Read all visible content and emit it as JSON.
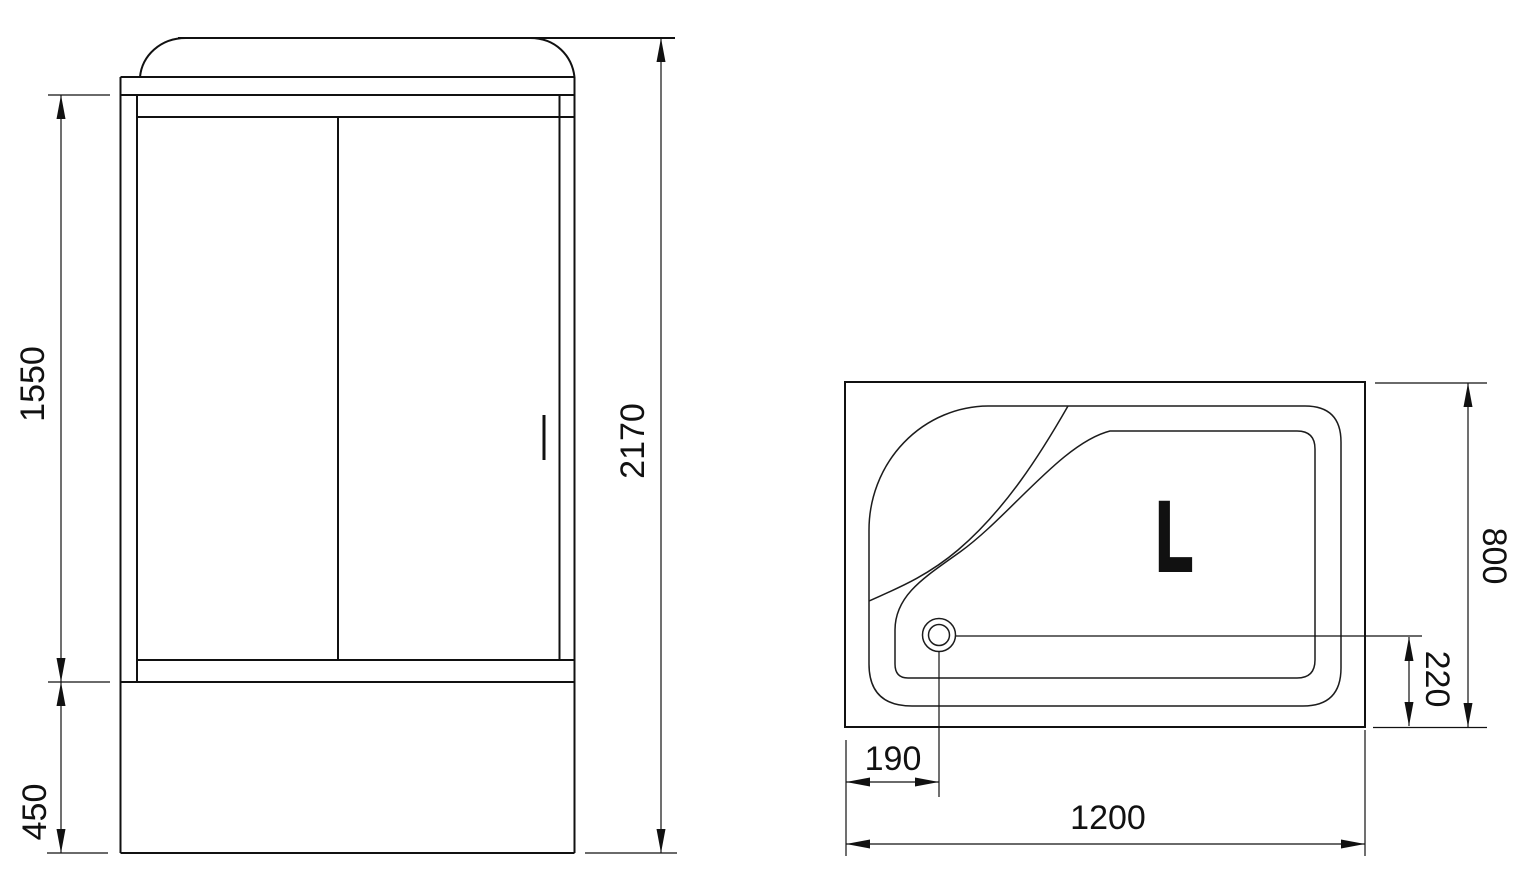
{
  "front_view": {
    "door_height": "1550",
    "base_height": "450",
    "total_height": "2170"
  },
  "plan_view": {
    "tray_width": "1200",
    "tray_depth": "800",
    "drain_offset_left": "190",
    "drain_offset_bottom": "220",
    "orientation_label": "L"
  },
  "colors": {
    "line": "#111111",
    "background": "#ffffff"
  }
}
